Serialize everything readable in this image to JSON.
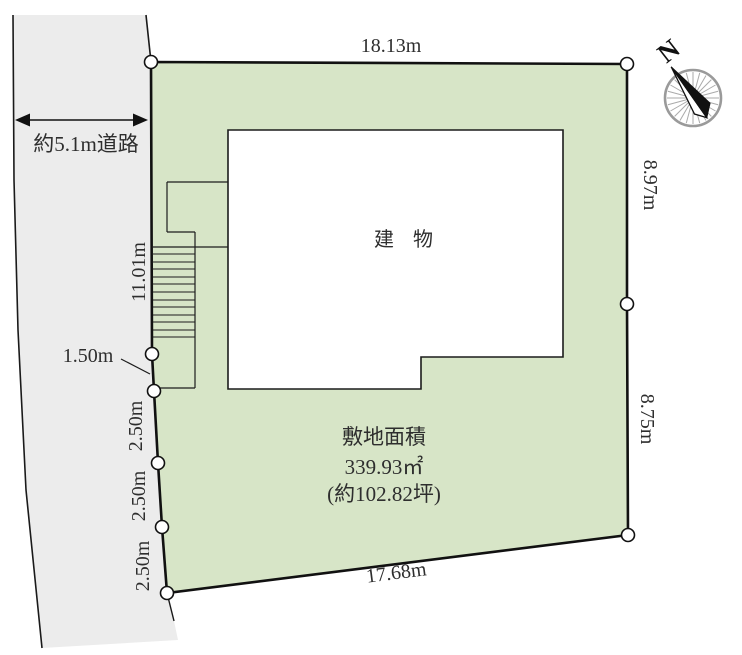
{
  "plan": {
    "road": {
      "width_label": "約5.1m道路"
    },
    "compass": {
      "north_label": "N"
    },
    "building": {
      "label": "建 物"
    },
    "site_area": {
      "heading": "敷地面積",
      "area_sqm": "339.93㎡",
      "area_tsubo": "(約102.82坪)"
    },
    "dimensions": {
      "top": "18.13m",
      "right_upper": "8.97m",
      "right_lower": "8.75m",
      "bottom": "17.68m",
      "left_upper": "11.01m",
      "left_step": "1.50m",
      "left_seg_1": "2.50m",
      "left_seg_2": "2.50m",
      "left_seg_3": "2.50m"
    },
    "colors": {
      "plot_fill": "#d7e5c7",
      "road_fill": "#ececec",
      "outline": "#1a1a1a",
      "text": "#2e2e2e",
      "compass_ring": "#9a9a9a"
    }
  }
}
